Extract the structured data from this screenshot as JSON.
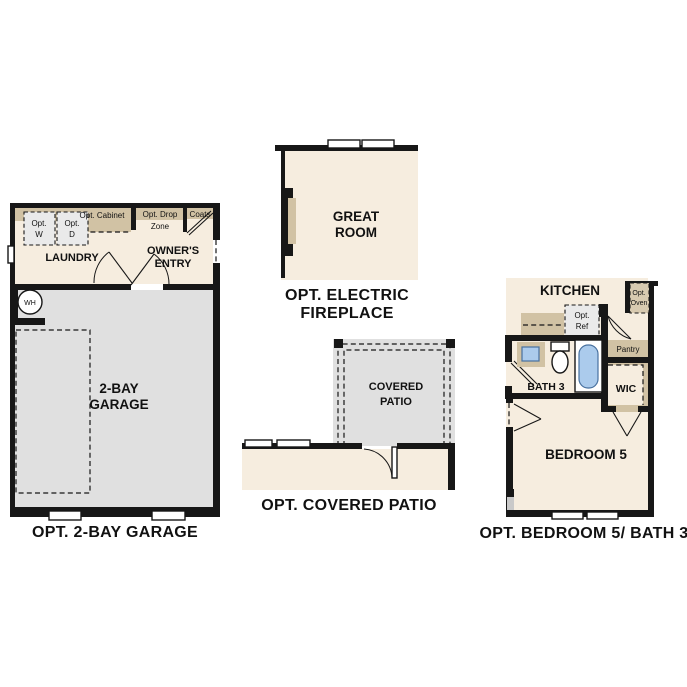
{
  "colors": {
    "background": "#ffffff",
    "wall": "#171717",
    "room_cream": "#f6eddf",
    "room_gray": "#e0e0e0",
    "cabinet_tan": "#d1c2a4",
    "appliance_gray": "#eaeaea",
    "fixture_blue": "#abcbec"
  },
  "garage_plan": {
    "caption": "OPT. 2-BAY GARAGE",
    "laundry": "LAUNDRY",
    "owners_entry": [
      "OWNER'S",
      "ENTRY"
    ],
    "garage": [
      "2-BAY",
      "GARAGE"
    ],
    "opt_washer": [
      "Opt.",
      "W"
    ],
    "opt_dryer": [
      "Opt.",
      "D"
    ],
    "opt_cabinet": "Opt. Cabinet",
    "opt_drop_zone": [
      "Opt. Drop",
      "Zone"
    ],
    "coats": "Coats",
    "water_heater": "WH"
  },
  "fireplace_plan": {
    "caption": [
      "OPT. ELECTRIC",
      "FIREPLACE"
    ],
    "great_room": [
      "GREAT",
      "ROOM"
    ]
  },
  "patio_plan": {
    "caption": "OPT. COVERED PATIO",
    "covered_patio": [
      "COVERED",
      "PATIO"
    ]
  },
  "bedroom_plan": {
    "caption": "OPT. BEDROOM 5/ BATH 3",
    "kitchen": "KITCHEN",
    "opt_ref": [
      "Opt.",
      "Ref"
    ],
    "opt_oven": [
      "Opt.",
      "Oven"
    ],
    "pantry": "Pantry",
    "bath": "BATH 3",
    "wic": "WIC",
    "bedroom": "BEDROOM 5"
  }
}
